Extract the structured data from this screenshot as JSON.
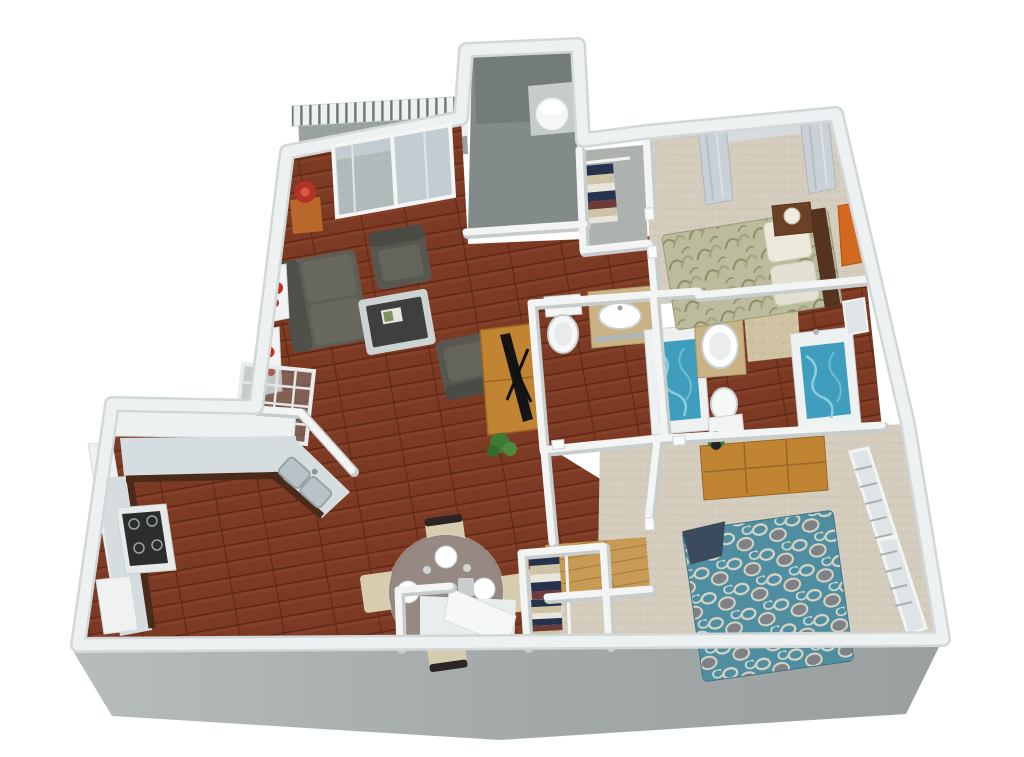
{
  "scene": {
    "type": "3d-floor-plan-render",
    "description": "Isometric 3D rendered floor plan of a two-bedroom / two-bathroom apartment with balcony, open living-dining area, U-shaped kitchen, utility closet with water heater, and walk-in closets",
    "background": "#ffffff"
  },
  "palette": {
    "wood": "#7c3a24",
    "woodDark": "#5d2715",
    "entryWood": "#c79a55",
    "carpet": "#d4cdbe",
    "wallTop": "#f3f5f5",
    "wallEdge": "#d2d7d7",
    "wallShadow": "#c7cdcd",
    "frontFaceLight": "#b7bcbc",
    "frontFaceDark": "#999f9f",
    "balconyFloor": "#9aa1a1",
    "utilityFloor": "#838a8a",
    "water": "#3f9dbe",
    "waterLight": "#8ccddd",
    "counter": "#d6dde0",
    "cabinetDark": "#4a2a18",
    "upperCabinet": "#eef1f2",
    "vanityTop": "#c9b385",
    "fixtureWhite": "#f4f6f6",
    "sofa": "#5e5e55",
    "sofaCushion": "#68685e",
    "bed1": "#bcbb9e",
    "bed1Accent": "#8e8e66",
    "bed2": "#4f8da0",
    "bed2Accent": "#d9d4c2",
    "headboard": "#54331f",
    "dresserWood": "#c08433",
    "lampShade": "#b23326",
    "artAccent": "#c03028",
    "plant": "#3f7a33",
    "glass": "#c3ccd1",
    "tile": "#cfc2a3",
    "linenNavy": "#27324e",
    "linenTan": "#cdc3a5",
    "linenWhite": "#e8e5da",
    "linenRed": "#6e3a3a"
  },
  "rooms": [
    {
      "id": "balcony",
      "name": "Balcony",
      "floor": "stone",
      "items": [
        "railing",
        "patio-chair",
        "patio-table"
      ]
    },
    {
      "id": "living-room",
      "name": "Living Room",
      "floor": "hardwood",
      "items": [
        "sofa",
        "armchair",
        "armchair",
        "coffee-table",
        "tv-console",
        "flat-tv",
        "floor-lamp",
        "side-table",
        "wall-art",
        "wall-art",
        "wire-rack",
        "plant",
        "sliding-glass-door"
      ]
    },
    {
      "id": "dining-area",
      "name": "Dining Area",
      "floor": "hardwood",
      "items": [
        "round-glass-table",
        "4-chairs",
        "4-place-settings"
      ]
    },
    {
      "id": "kitchen",
      "name": "Kitchen",
      "floor": "hardwood",
      "items": [
        "u-shaped-counter",
        "double-sink",
        "range",
        "refrigerator",
        "upper-cabinets",
        "pantry"
      ]
    },
    {
      "id": "entry",
      "name": "Entry",
      "floor": "light-wood",
      "items": [
        "door-mat-landing"
      ]
    },
    {
      "id": "utility-closet",
      "name": "Utility Closet",
      "floor": "concrete",
      "items": [
        "water-heater"
      ]
    },
    {
      "id": "bedroom-1",
      "name": "Bedroom 1",
      "floor": "carpet",
      "items": [
        "queen-bed",
        "nightstand",
        "table-lamp",
        "wall-art",
        "window-curtains",
        "linen-closet"
      ]
    },
    {
      "id": "bathroom-1",
      "name": "Bathroom 1",
      "floor": "hardwood",
      "items": [
        "toilet",
        "vanity-sink",
        "bathtub"
      ]
    },
    {
      "id": "bathroom-2",
      "name": "Bathroom 2",
      "floor": "hardwood",
      "items": [
        "toilet",
        "oval-sink-vanity",
        "bathtub",
        "tiled-shower",
        "small-window"
      ]
    },
    {
      "id": "bedroom-2",
      "name": "Bedroom 2",
      "floor": "carpet",
      "items": [
        "queen-bed",
        "dresser",
        "plant",
        "windows-with-blinds",
        "walk-in-closet"
      ]
    },
    {
      "id": "closet-2",
      "name": "Closet",
      "floor": "carpet",
      "items": [
        "linen-stacks",
        "closet-rod"
      ]
    }
  ]
}
